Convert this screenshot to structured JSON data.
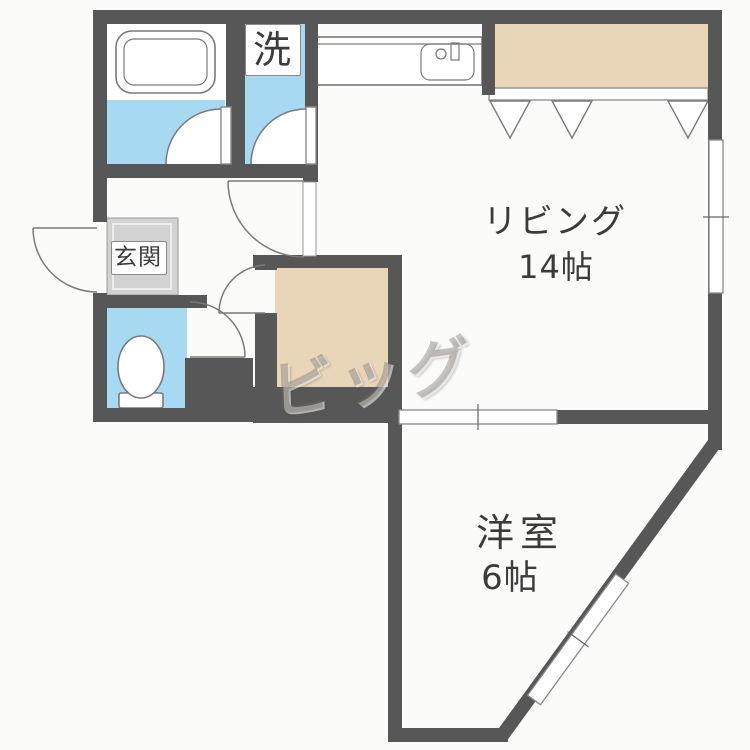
{
  "plan": {
    "watermark": "ビッグ",
    "rooms": {
      "living": {
        "name": "リビング",
        "size": "14帖"
      },
      "western": {
        "name": "洋室",
        "size": "6帖"
      },
      "entrance": {
        "name": "玄関"
      },
      "laundry": {
        "name": "洗"
      }
    },
    "colors": {
      "wall": "#575757",
      "water": "#a8d9f2",
      "closet": "#e9d5b8",
      "entrance_floor": "#d2d2d2",
      "text": "#3b3b3b"
    }
  }
}
